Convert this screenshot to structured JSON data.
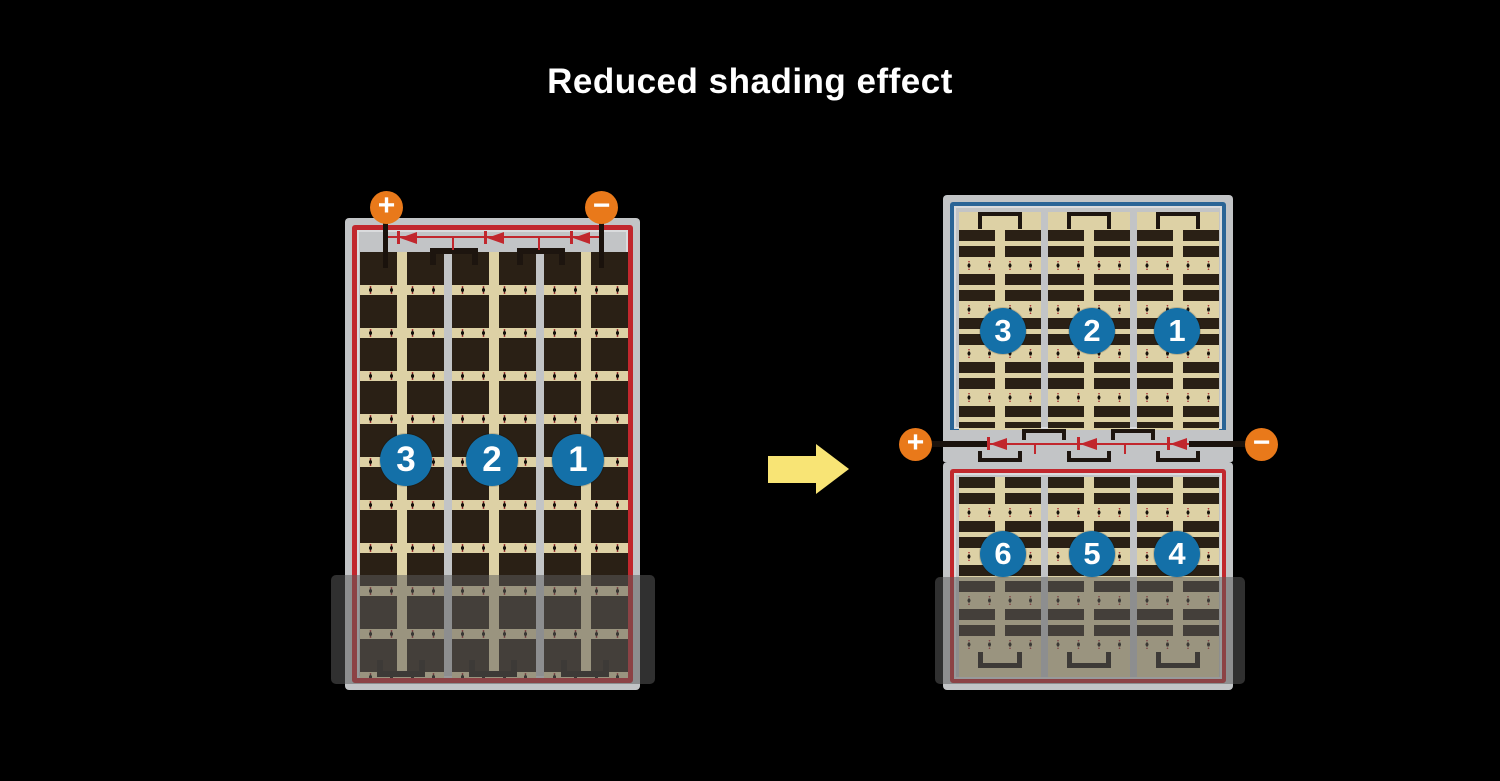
{
  "title": "Reduced shading effect",
  "colors": {
    "background": "#000000",
    "terminal_orange": "#e9791a",
    "string_badge_blue": "#1470a8",
    "module_border_red": "#c1272d",
    "module_border_blue": "#2a6496",
    "cell_dark": "#2a2015",
    "cell_field_tan": "#ddd1a5",
    "frame_gray": "#c2c4c6",
    "arrow_yellow": "#f8e475",
    "shade_overlay": "rgba(92,92,92,0.52)"
  },
  "left_module": {
    "terminals": {
      "plus": "+",
      "minus": "−"
    },
    "diode_count": 3,
    "strings": [
      {
        "label": "3"
      },
      {
        "label": "2"
      },
      {
        "label": "1"
      }
    ],
    "shaded": true
  },
  "right_module": {
    "terminals": {
      "plus": "+",
      "minus": "−"
    },
    "diode_count": 3,
    "top_half_strings": [
      {
        "label": "3"
      },
      {
        "label": "2"
      },
      {
        "label": "1"
      }
    ],
    "bottom_half_strings": [
      {
        "label": "6"
      },
      {
        "label": "5"
      },
      {
        "label": "4"
      }
    ],
    "shaded": true
  }
}
